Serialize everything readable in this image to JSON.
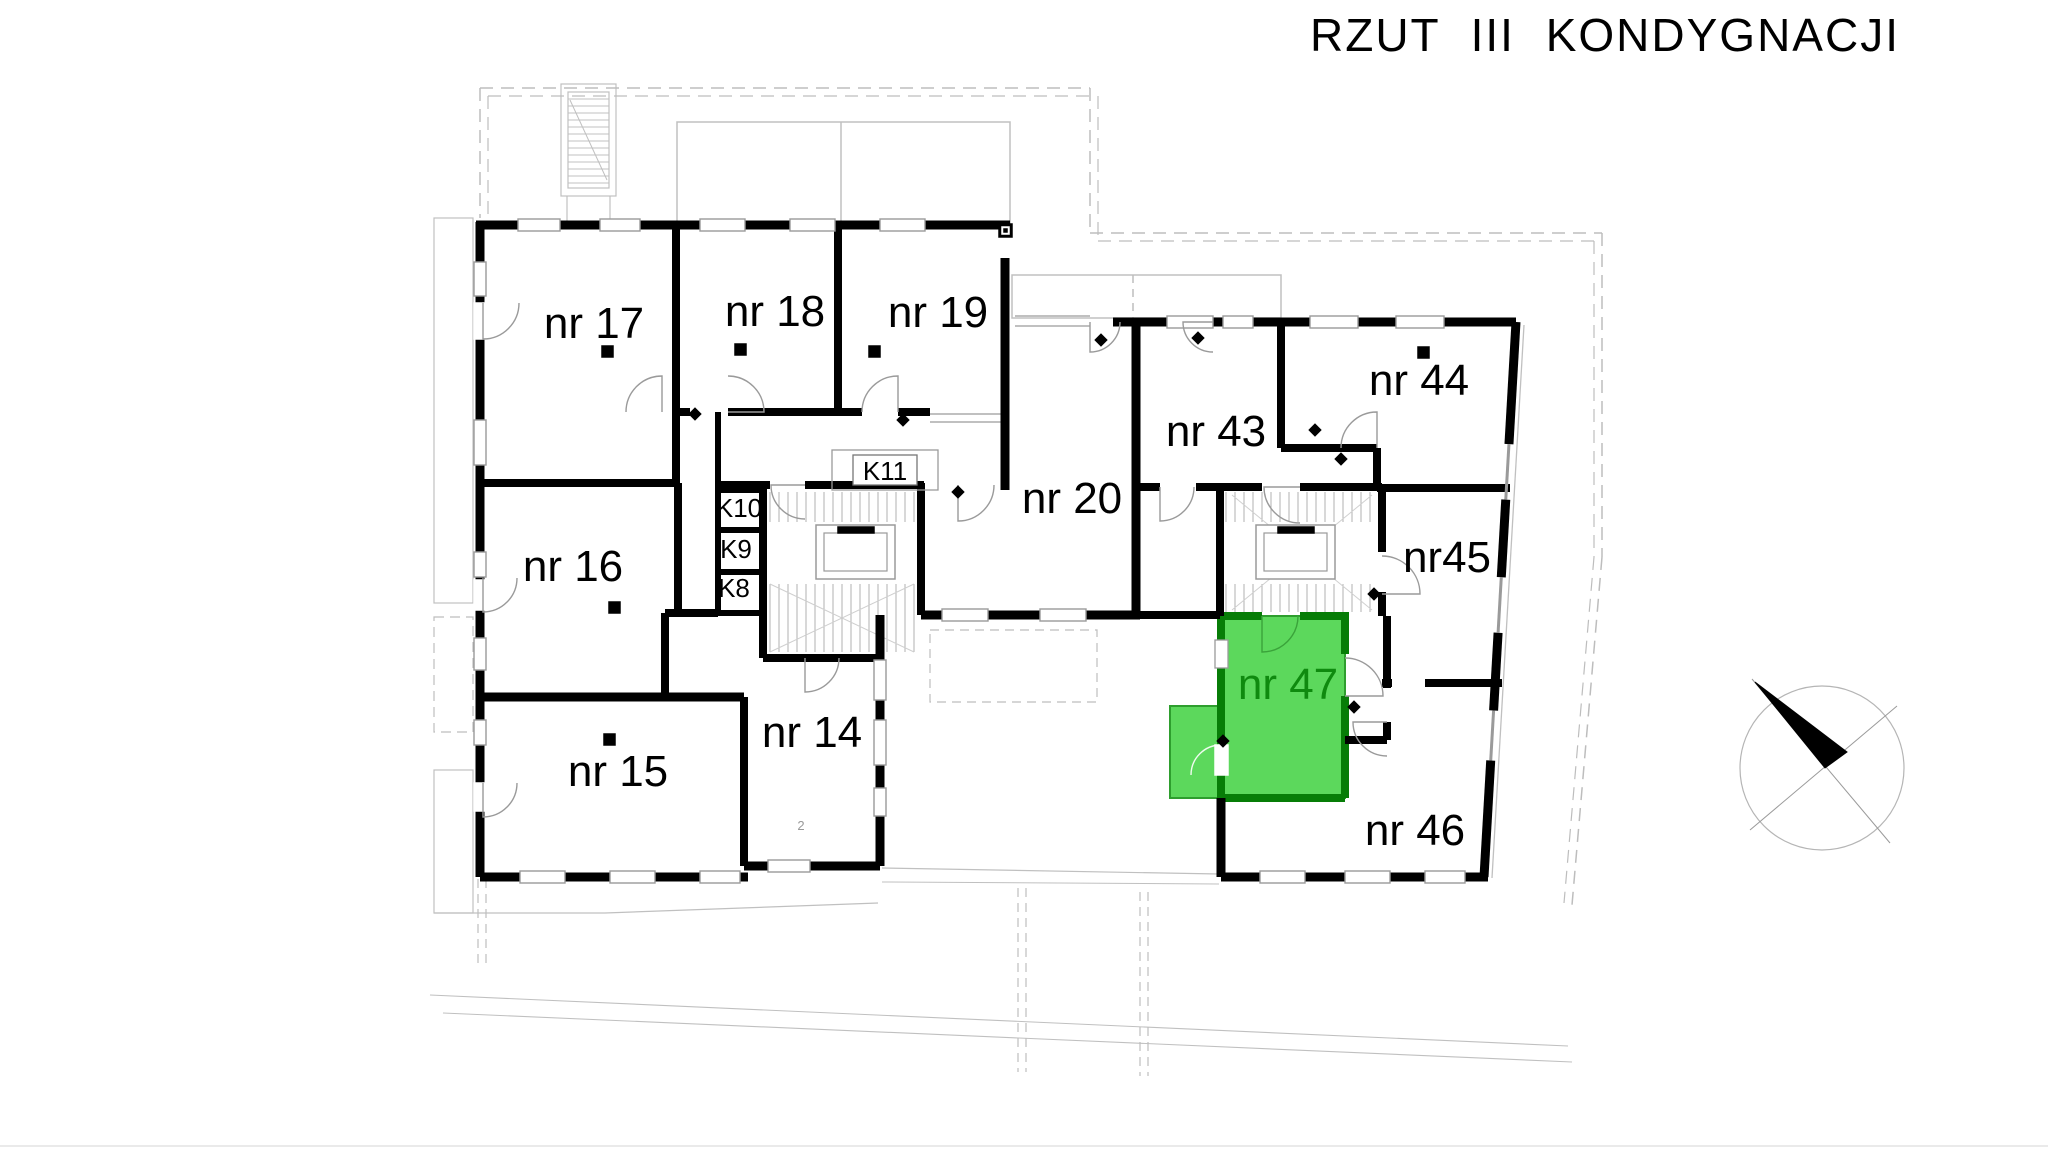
{
  "header": {
    "title": "RZUT III KONDYGNACJI"
  },
  "floor_plan": {
    "rooms": [
      {
        "id": "nr17",
        "label": "nr 17"
      },
      {
        "id": "nr18",
        "label": "nr 18"
      },
      {
        "id": "nr19",
        "label": "nr 19"
      },
      {
        "id": "nr20",
        "label": "nr 20"
      },
      {
        "id": "nr43",
        "label": "nr 43"
      },
      {
        "id": "nr44",
        "label": "nr 44"
      },
      {
        "id": "nr45",
        "label": "nr45"
      },
      {
        "id": "nr46",
        "label": "nr 46"
      },
      {
        "id": "nr16",
        "label": "nr 16"
      },
      {
        "id": "nr15",
        "label": "nr 15"
      },
      {
        "id": "nr14",
        "label": "nr 14"
      }
    ],
    "closets": [
      {
        "id": "K8",
        "label": "K8"
      },
      {
        "id": "K9",
        "label": "K9"
      },
      {
        "id": "K10",
        "label": "K10"
      },
      {
        "id": "K11",
        "label": "K11"
      }
    ],
    "highlighted_room": {
      "id": "nr47",
      "label": "nr 47"
    },
    "tiny_mark": "2",
    "colors": {
      "wall": "#000000",
      "highlight_fill": "#5cd85c",
      "highlight_wall": "#077d07",
      "highlight_text": "#0f8a0f",
      "line_light": "#c0c0c0",
      "line_mid": "#9a9a9a",
      "dashed": "#bdbdbd"
    }
  },
  "compass": {
    "icon": "north-arrow-icon"
  }
}
